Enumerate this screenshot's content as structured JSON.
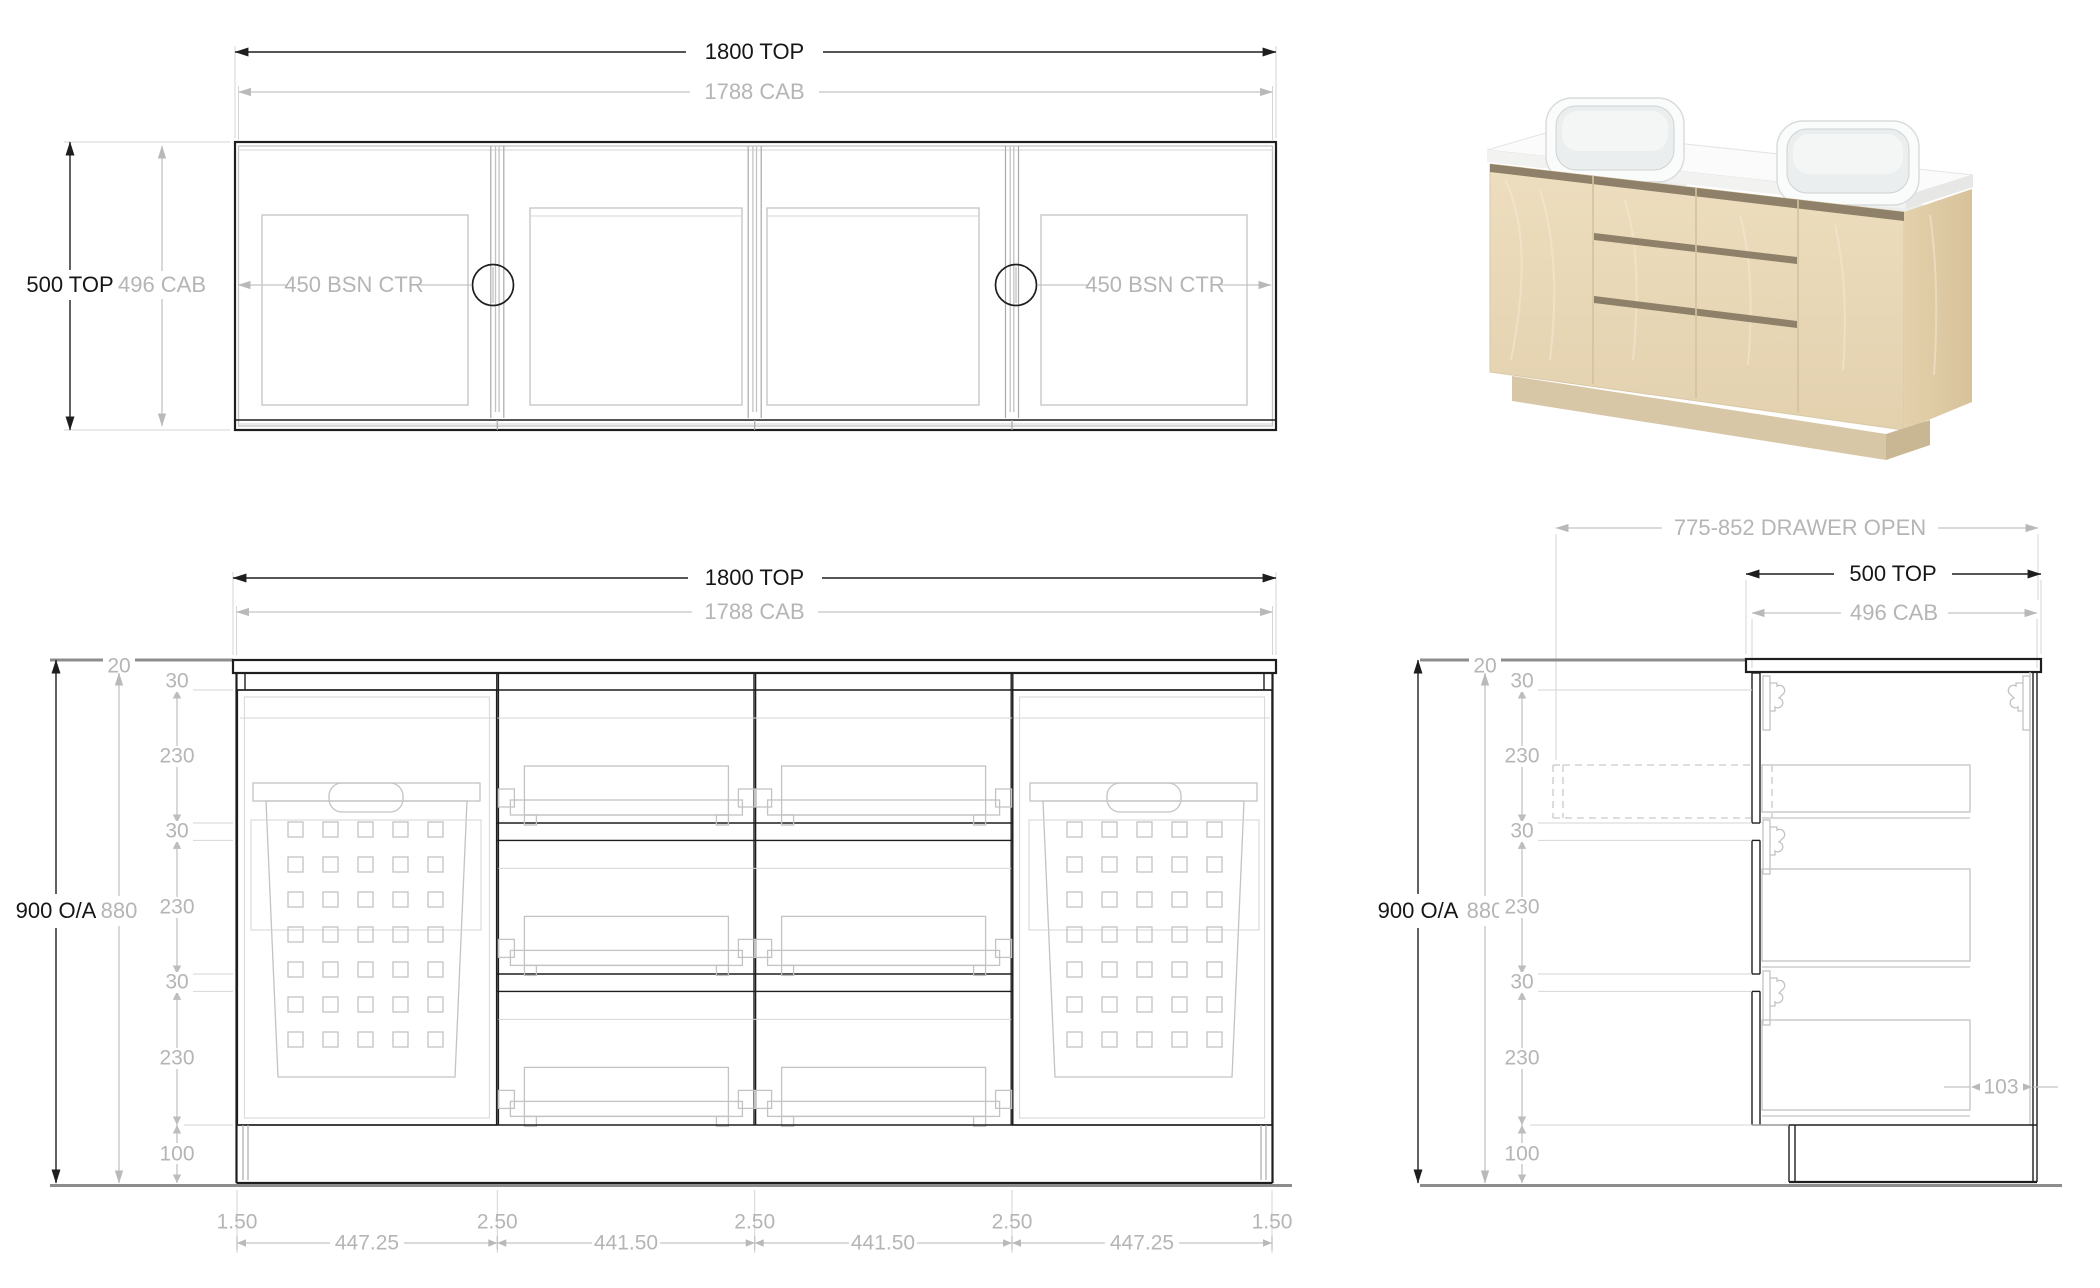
{
  "plan": {
    "dim_width_top": "1800 TOP",
    "dim_width_cab": "1788 CAB",
    "dim_depth_top": "500 TOP",
    "dim_depth_cab": "496 CAB",
    "dim_basin_left": "450 BSN CTR",
    "dim_basin_right": "450 BSN CTR"
  },
  "front": {
    "dim_width_top": "1800 TOP",
    "dim_width_cab": "1788 CAB",
    "dim_height_overall": "900 O/A",
    "dim_height_cab": "880",
    "dim_top_thickness": "20",
    "segments": [
      "30",
      "230",
      "30",
      "230",
      "30",
      "230",
      "100"
    ],
    "gaps": [
      "1.50",
      "2.50",
      "2.50",
      "2.50",
      "1.50"
    ],
    "panels": [
      "447.25",
      "441.50",
      "441.50",
      "447.25"
    ]
  },
  "side": {
    "dim_drawer_open": "775-852 DRAWER OPEN",
    "dim_depth_top": "500 TOP",
    "dim_depth_cab": "496 CAB",
    "dim_height_overall": "900 O/A",
    "dim_height_cab": "880",
    "dim_top_thickness": "20",
    "segments": [
      "30",
      "230",
      "30",
      "230",
      "30",
      "230",
      "100"
    ],
    "dim_back_gap": "103"
  },
  "render": {
    "colors": {
      "wood_front_a": "#eddebf",
      "wood_front_b": "#e3d1ae",
      "wood_side_a": "#e4d1ab",
      "wood_side_b": "#d7c29a",
      "counter": "#fbfbfb",
      "fascia": "#f2f2f1",
      "side_fascia": "#e7e7e5",
      "shadow": "#8f8069",
      "kick": "#d8c7a6",
      "kick_side": "#c9b693",
      "basin": "#fafbfb",
      "basin_inner": "#ebeeee"
    }
  }
}
